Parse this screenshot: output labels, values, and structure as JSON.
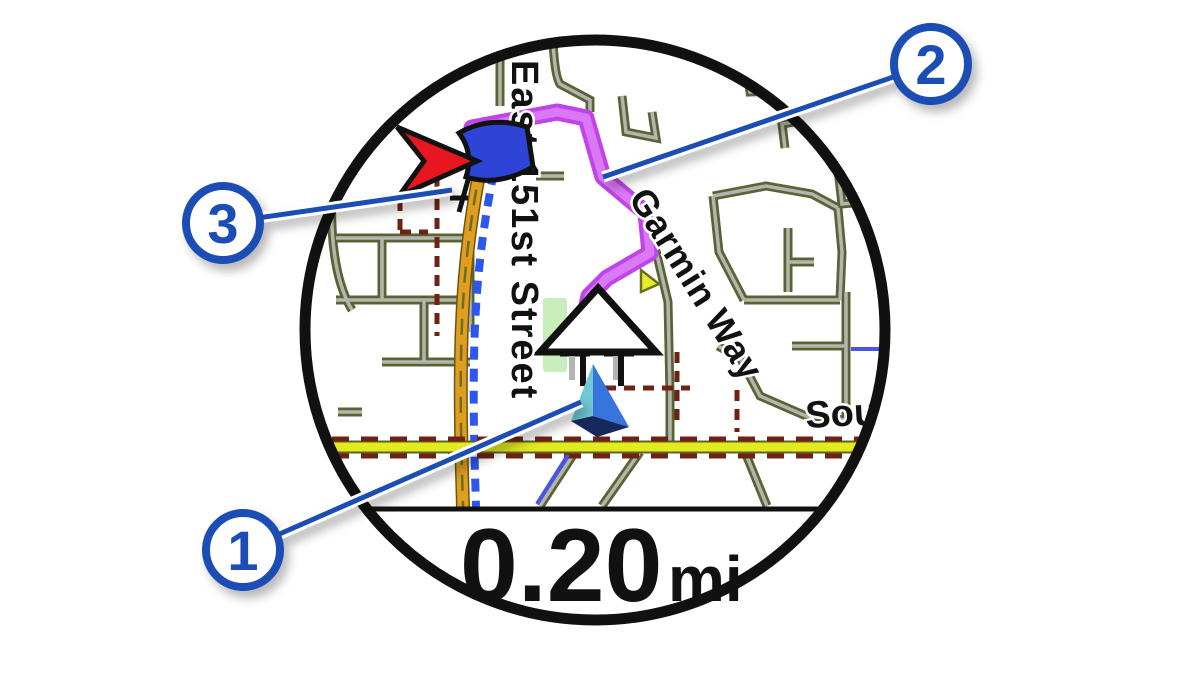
{
  "figure": {
    "type": "annotated watch map navigation screen"
  },
  "watch": {
    "data_field": {
      "distance_value": "0.20",
      "distance_unit": "mi"
    },
    "map": {
      "street_labels": {
        "vertical": "East 151st Street",
        "diagonal": "Garmin Way",
        "partial_right": "Sout"
      },
      "markers": [
        "current-position-marker",
        "course-route-line",
        "destination-flag-and-pointer"
      ]
    }
  },
  "callouts": [
    {
      "number": "1"
    },
    {
      "number": "2"
    },
    {
      "number": "3"
    }
  ],
  "colors": {
    "callout_blue": "#1b4eb5",
    "route_magenta_core": "#da78f6",
    "route_magenta_edge": "#bf44ea",
    "road_orange": "#e09d1e",
    "road_yellow": "#e2ea20",
    "street_olive": "#5a6334",
    "street_gray": "#b2b6ae",
    "dash_blue": "#2d55ef",
    "dash_maroon": "#6f2214",
    "marker_cyan": "#6fc9d6",
    "marker_blue": "#3575dc",
    "marker_navy": "#16295c",
    "pointer_red": "#e8161f",
    "flag_blue": "#2e44d6",
    "park_green": "#c9eebc",
    "bezel_black": "#111111"
  }
}
